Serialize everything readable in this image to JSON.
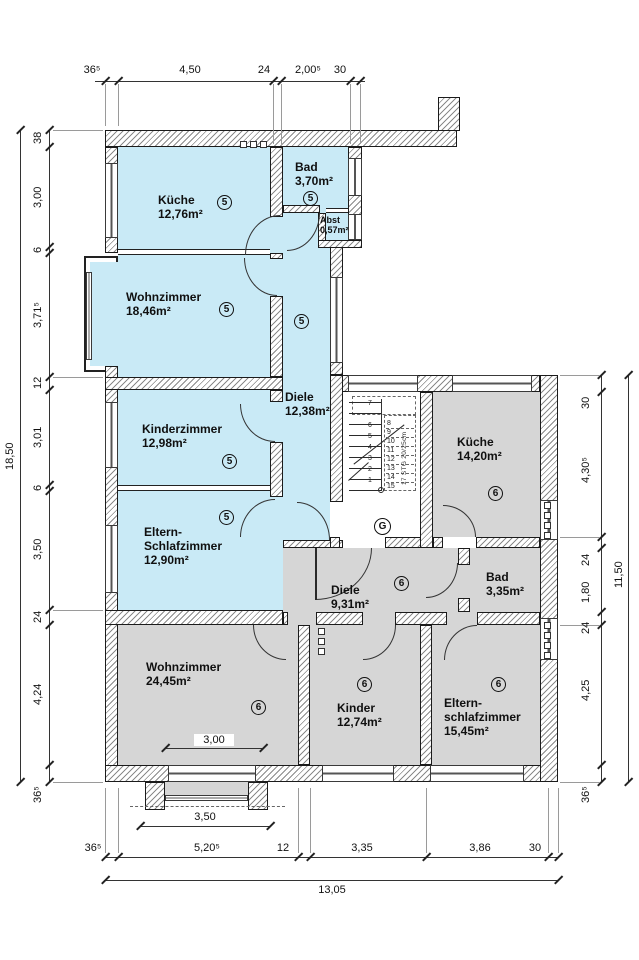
{
  "colors": {
    "apartment5_fill": "#c9eaf6",
    "apartment6_fill": "#d6d6d6",
    "wall_line": "#1b1b1b"
  },
  "units": {
    "five": "5",
    "six": "6"
  },
  "rooms": {
    "kueche5": {
      "name": "Küche",
      "area": "12,76m²"
    },
    "bad5": {
      "name": "Bad",
      "area": "3,70m²"
    },
    "abst5": {
      "name": "Abst",
      "area": "0,57m²"
    },
    "wohnzimmer5": {
      "name": "Wohnzimmer",
      "area": "18,46m²"
    },
    "diele5": {
      "name": "Diele",
      "area": "12,38m²"
    },
    "kinderzimmer5": {
      "name": "Kinderzimmer",
      "area": "12,98m²"
    },
    "eltern5": {
      "name": "Eltern-\nSchlafzimmer",
      "area": "12,90m²"
    },
    "kueche6": {
      "name": "Küche",
      "area": "14,20m²"
    },
    "diele6": {
      "name": "Diele",
      "area": "9,31m²"
    },
    "bad6": {
      "name": "Bad",
      "area": "3,35m²"
    },
    "wohnzimmer6": {
      "name": "Wohnzimmer",
      "area": "24,45m²"
    },
    "kinder6": {
      "name": "Kinder",
      "area": "12,74m²"
    },
    "eltern6": {
      "name": "Eltern-\nschlafzimmer",
      "area": "15,45m²"
    }
  },
  "stairwell": {
    "label": "G",
    "steps_solid": [
      "1",
      "2",
      "3",
      "4",
      "5",
      "6",
      "7"
    ],
    "steps_dashed": [
      "8",
      "9",
      "10",
      "11",
      "12",
      "13",
      "14",
      "15"
    ],
    "note": "17 STG 20/25cm"
  },
  "dimensions": {
    "top": [
      "36⁵",
      "4,50",
      "24",
      "2,00⁵",
      "30"
    ],
    "left": [
      "38",
      "3,00",
      "6",
      "3,71⁵",
      "12",
      "3,01",
      "6",
      "3,50",
      "24",
      "4,24",
      "36⁵"
    ],
    "left_total": "18,50",
    "right": [
      "30",
      "4,30⁵",
      "24",
      "1,80",
      "24",
      "4,25",
      "36⁵"
    ],
    "right_total": "11,50",
    "bottom": [
      "36⁵",
      "5,20⁵",
      "12",
      "3,35",
      "3,86",
      "30"
    ],
    "bottom_total": "13,05",
    "balcony_inner": "3,00",
    "balcony_outer": "3,50"
  }
}
